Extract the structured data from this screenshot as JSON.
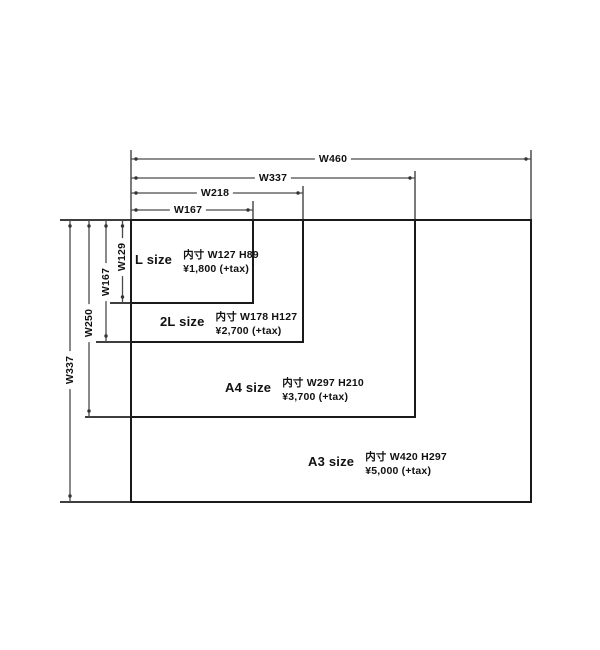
{
  "diagram": {
    "frames": [
      {
        "name": "L",
        "label": "L size",
        "inner_size": "内寸 W127 H89",
        "price": "¥1,800 (+tax)"
      },
      {
        "name": "2L",
        "label": "2L size",
        "inner_size": "内寸 W178 H127",
        "price": "¥2,700 (+tax)"
      },
      {
        "name": "A4",
        "label": "A4 size",
        "inner_size": "内寸 W297 H210",
        "price": "¥3,700 (+tax)"
      },
      {
        "name": "A3",
        "label": "A3 size",
        "inner_size": "内寸 W420 H297",
        "price": "¥5,000 (+tax)"
      }
    ],
    "width_dimensions": [
      {
        "label": "W460"
      },
      {
        "label": "W337"
      },
      {
        "label": "W218"
      },
      {
        "label": "W167"
      }
    ],
    "height_dimensions": [
      {
        "label": "W337"
      },
      {
        "label": "W250"
      },
      {
        "label": "W167"
      },
      {
        "label": "W129"
      }
    ],
    "colors": {
      "dim_line": "#4a4a4a",
      "frame_border": "#1a1a1a",
      "text": "#111111",
      "background": "#ffffff"
    }
  }
}
